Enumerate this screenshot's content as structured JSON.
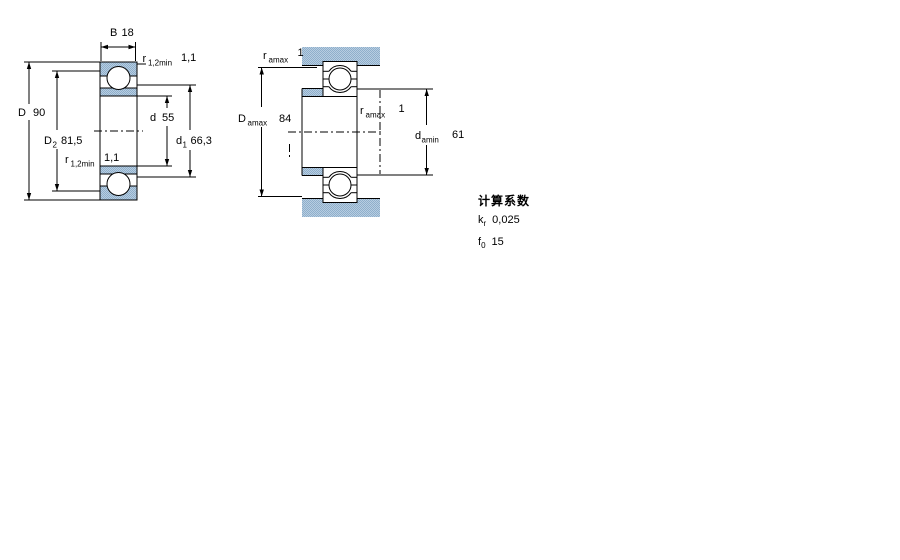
{
  "left_figure": {
    "B": {
      "sym": "B",
      "val": "18"
    },
    "D": {
      "sym": "D",
      "val": "90"
    },
    "D2": {
      "sym": "D",
      "sub": "2",
      "val": "81,5"
    },
    "r_top": {
      "sym": "r",
      "sub": "1,2min",
      "val": "1,1"
    },
    "r_bot": {
      "sym": "r",
      "sub": "1,2min",
      "val": "1,1"
    },
    "d": {
      "sym": "d",
      "val": "55"
    },
    "d1": {
      "sym": "d",
      "sub": "1",
      "val": "66,3"
    }
  },
  "right_figure": {
    "r_amax_top": {
      "sym": "r",
      "sub": "amax",
      "val": "1"
    },
    "D_amax": {
      "sym": "D",
      "sub": "amax",
      "val": "84"
    },
    "r_amax_mid": {
      "sym": "r",
      "sub": "amax",
      "val": "1"
    },
    "d_amin": {
      "sym": "d",
      "sub": "amin",
      "val": "61"
    }
  },
  "calculation_factors": {
    "title": "计算系数",
    "kr": {
      "sym": "k",
      "sub": "r",
      "val": "0,025"
    },
    "f0": {
      "sym": "f",
      "sub": "0",
      "val": "15"
    }
  },
  "colors": {
    "steel_blue_light": "#b7cde1",
    "steel_blue_dark": "#8fafcb",
    "line": "#000000"
  }
}
